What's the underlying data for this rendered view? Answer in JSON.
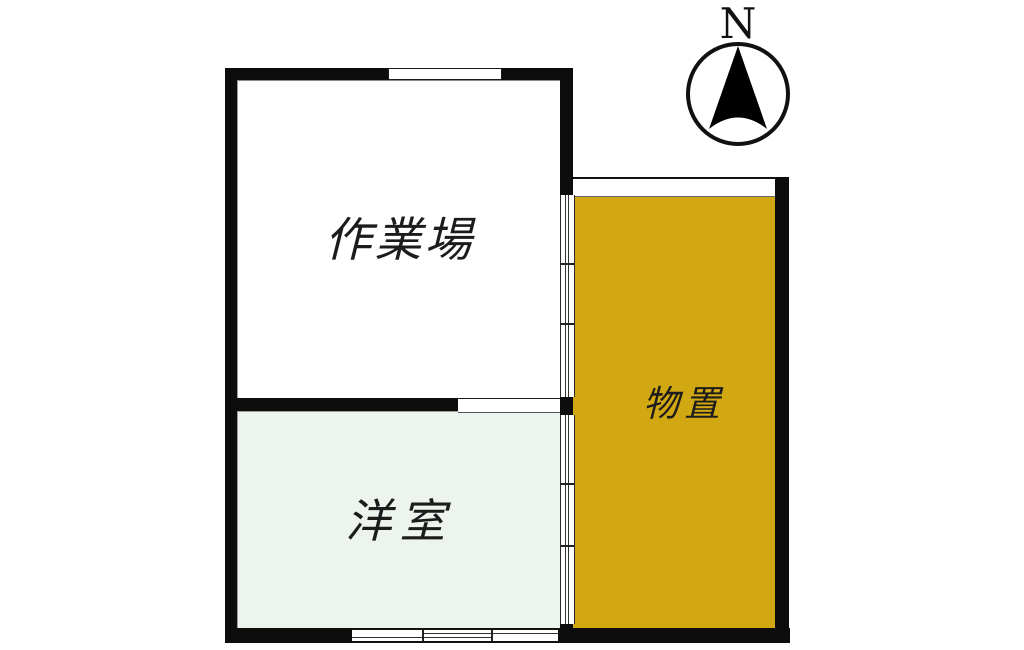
{
  "page": {
    "type": "floor-plan",
    "background": "#ffffff"
  },
  "compass": {
    "north_label": "N"
  },
  "rooms": [
    {
      "id": "workshop",
      "label": "作業場",
      "fill": "#ffffff"
    },
    {
      "id": "western-room",
      "label": "洋室",
      "fill": "#edf4ed"
    },
    {
      "id": "storage",
      "label": "物置",
      "fill": "#d1a811"
    }
  ],
  "colors": {
    "wall": "#0d0d0d",
    "label_text": "#1c1c1c",
    "storage_fill": "#d1a811",
    "western_room_fill": "#edf4ed",
    "workshop_fill": "#ffffff"
  }
}
